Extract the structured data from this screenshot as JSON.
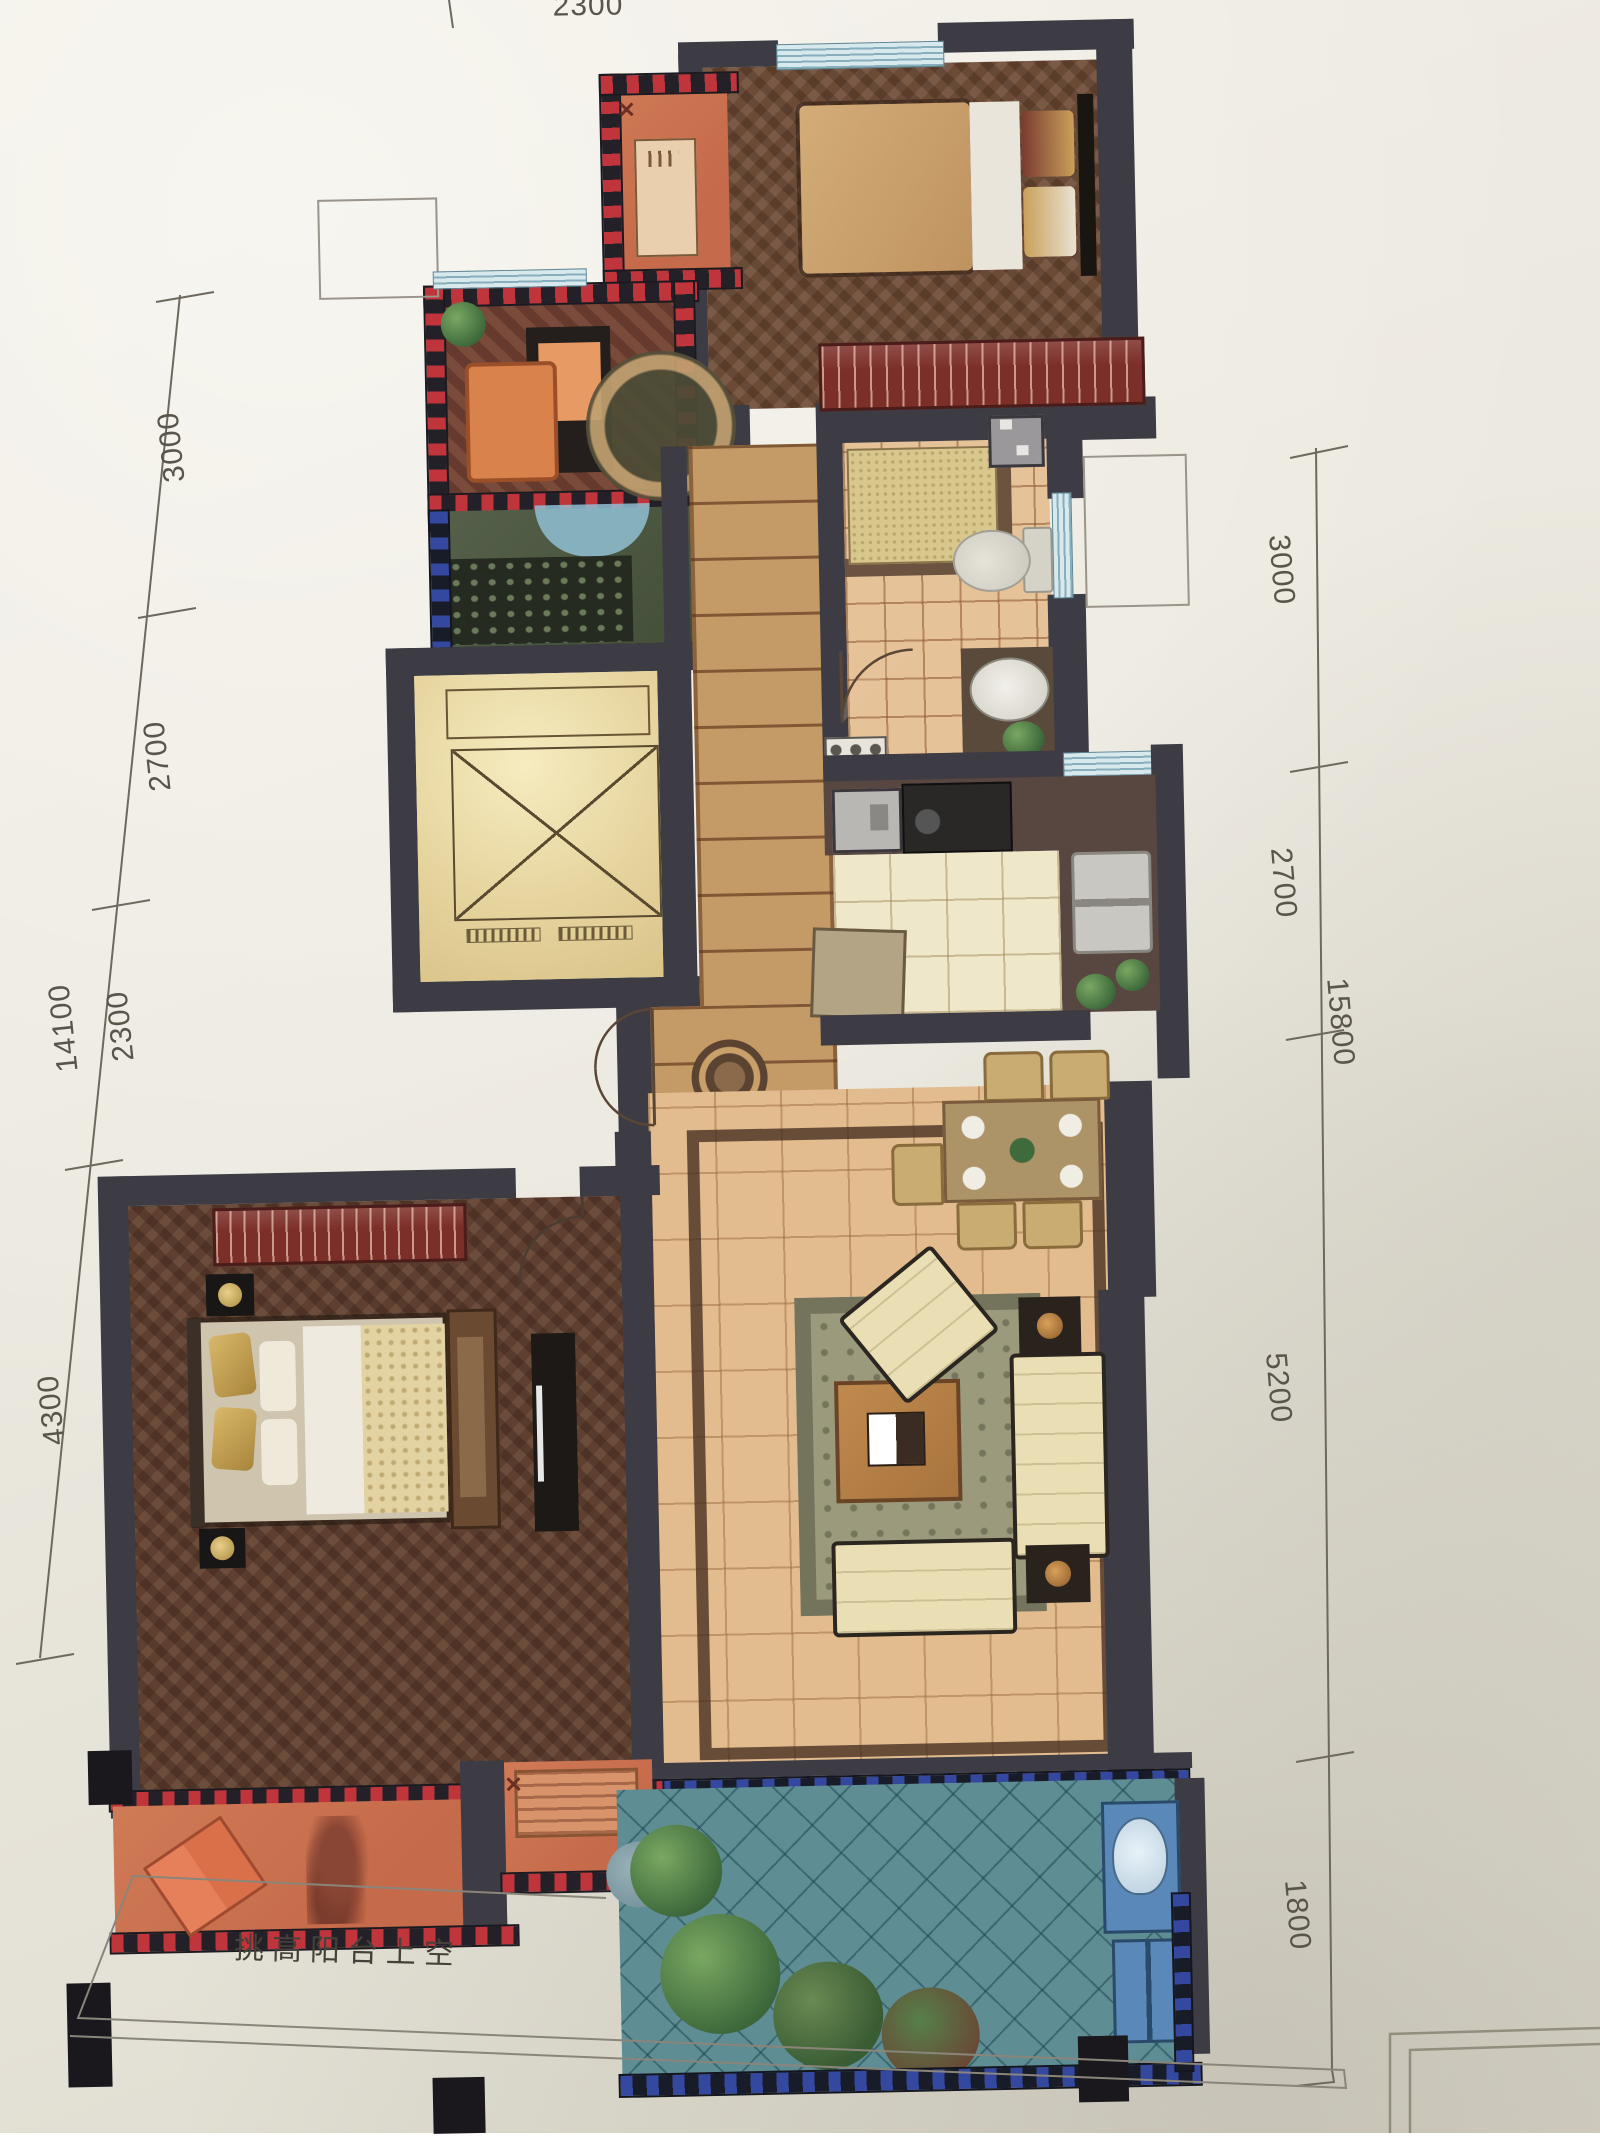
{
  "meta": {
    "description": "Photograph of a printed apartment floor plan with metric dimension strings"
  },
  "dimensions": {
    "top": {
      "labels": [
        "2300"
      ]
    },
    "left": {
      "total": "14100",
      "segments": [
        "3000",
        "2700",
        "2300",
        "4300"
      ]
    },
    "right": {
      "total": "15800",
      "segments": [
        "3000",
        "2700",
        "5200",
        "1800"
      ]
    }
  },
  "annotations": {
    "balcony_void_label": "挑高阳台上空"
  },
  "icons": {
    "x_mark": "✕"
  },
  "colors": {
    "wall": "#3d3c44",
    "redDash": "#c0343c",
    "blueDash": "#3548a0",
    "parquet": "#6b4a36",
    "parquet2": "#5f4030",
    "tile": "#e6c298",
    "ktile": "#efe7ca",
    "ltile": "#e2bc8e",
    "ctile": "#c49a66",
    "teal": "#5e8d94",
    "cream": "#eadfb4",
    "wardrobe": "#7c2e28",
    "orange": "#cc7050"
  }
}
